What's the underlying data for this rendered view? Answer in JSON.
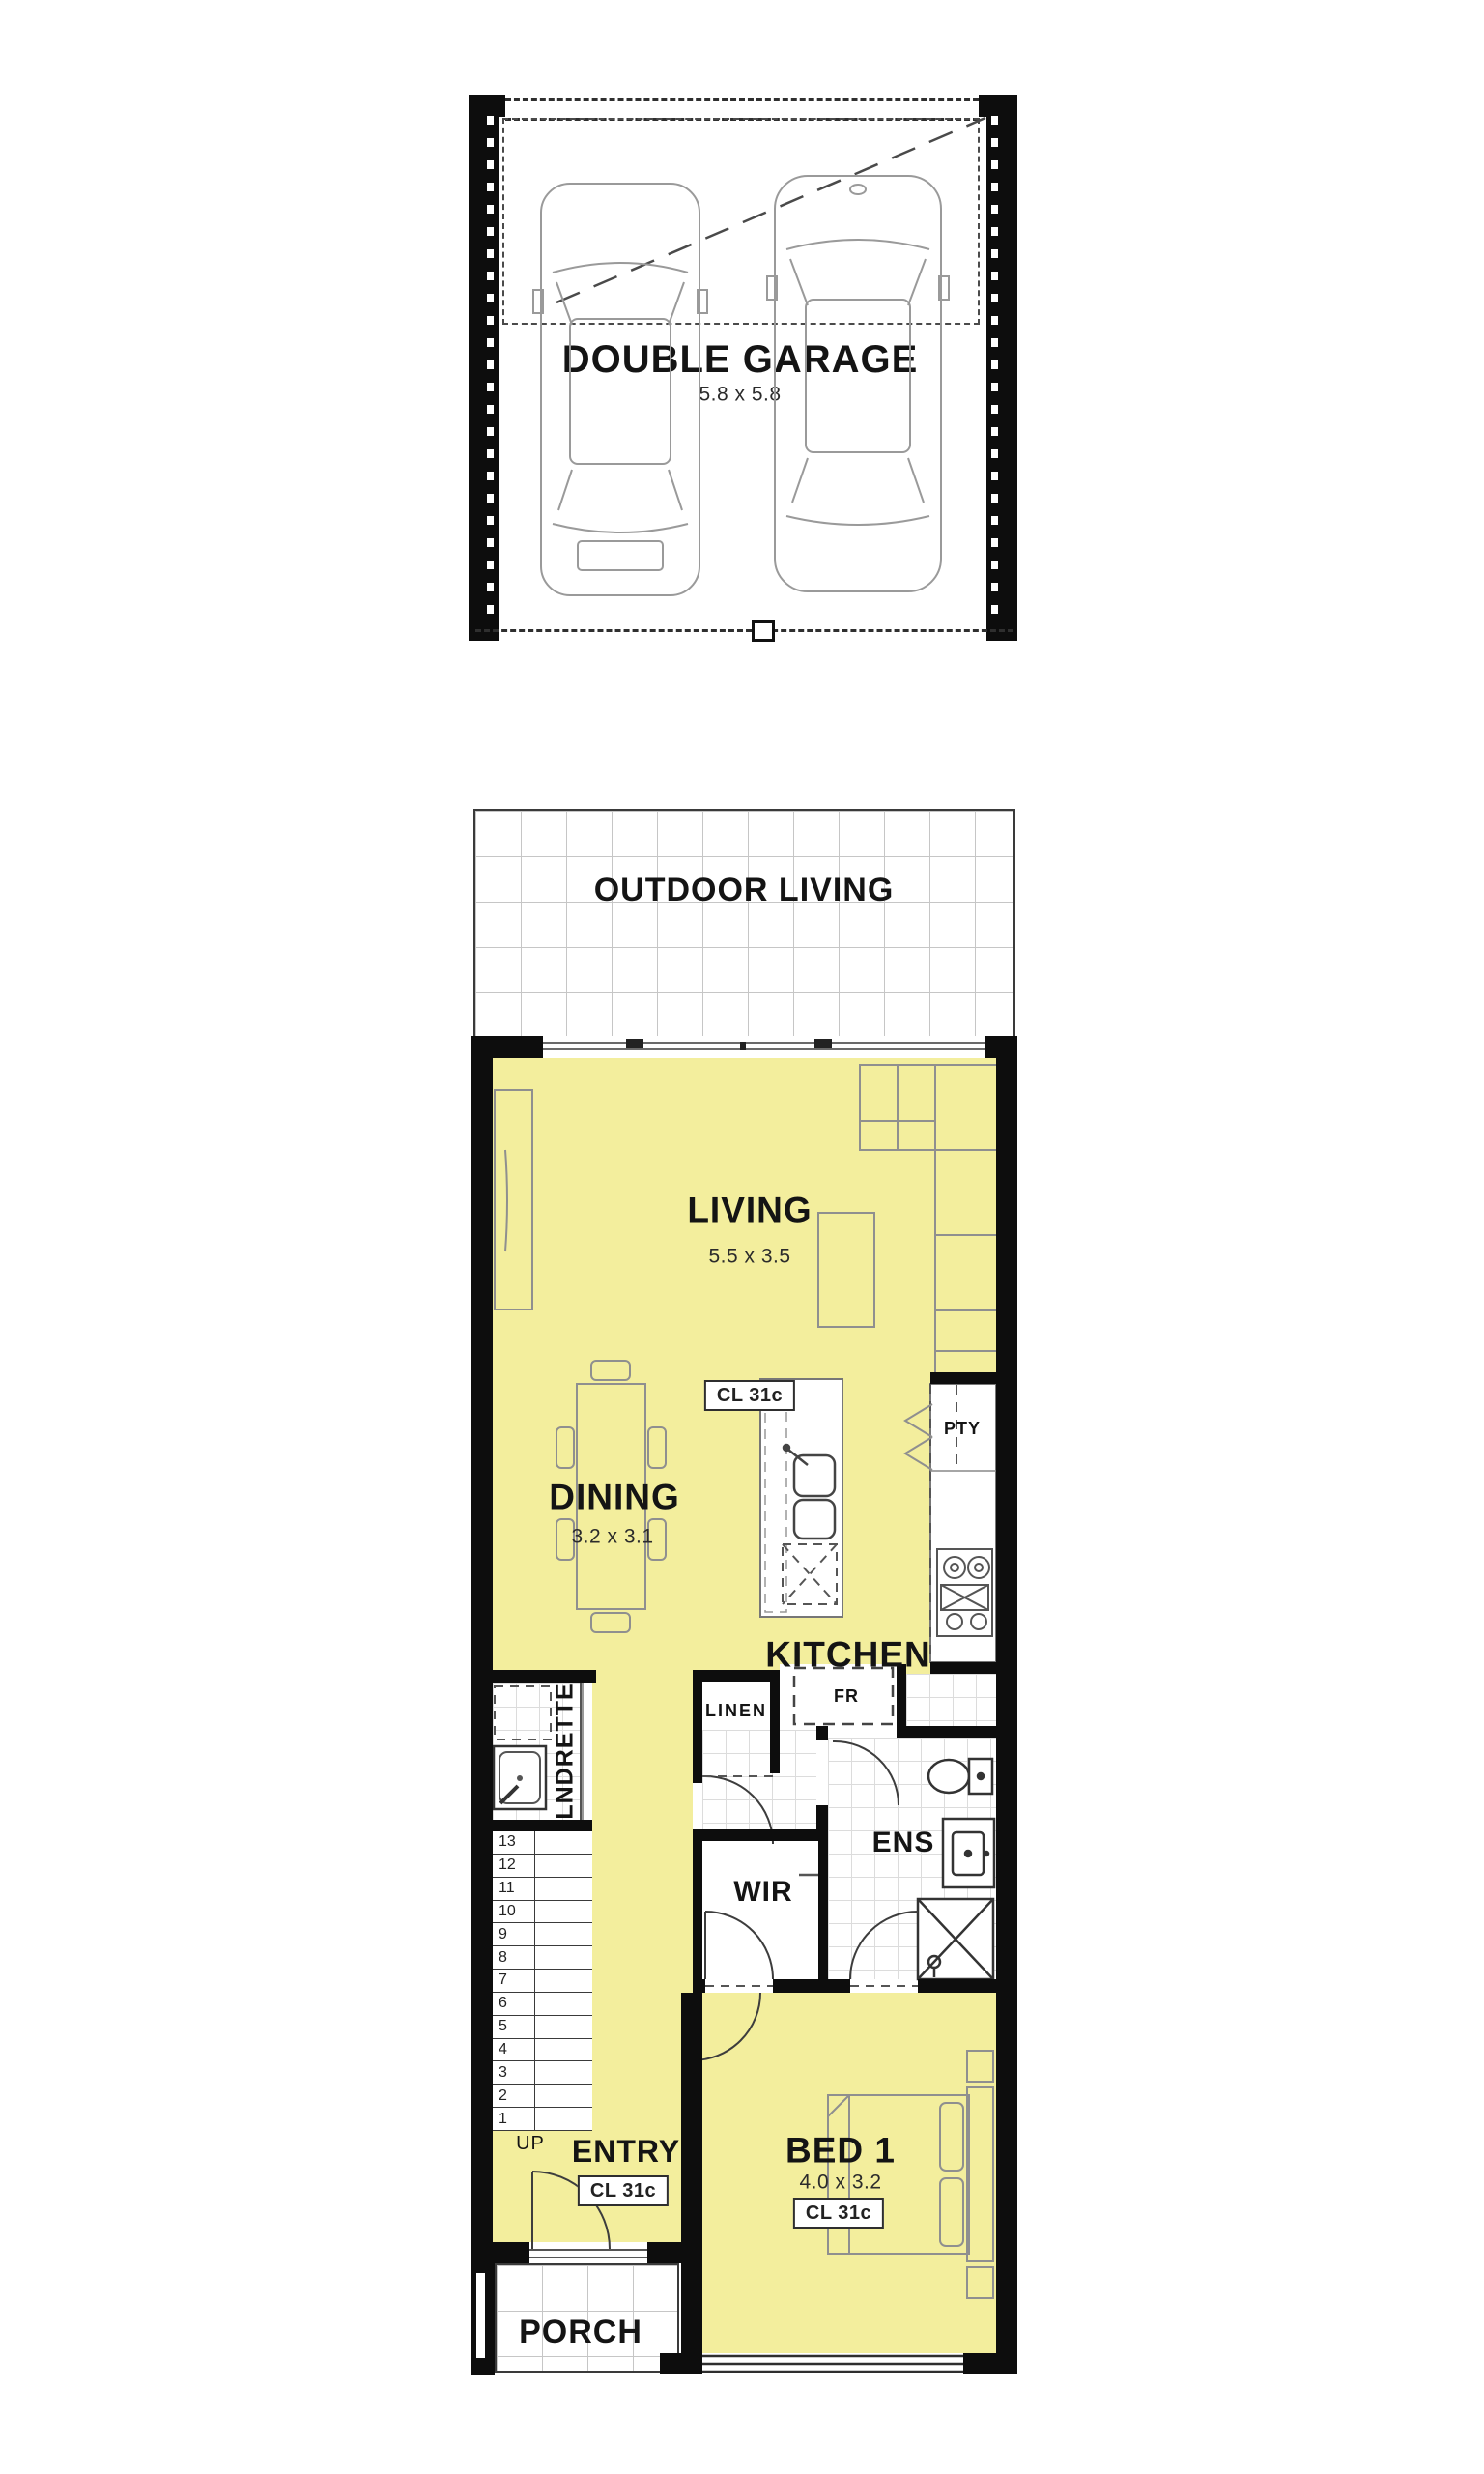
{
  "plan": {
    "garage": {
      "label": "DOUBLE GARAGE",
      "dims": "5.8 x 5.8"
    },
    "outdoor_living": {
      "label": "OUTDOOR LIVING"
    },
    "living": {
      "label": "LIVING",
      "dims": "5.5 x 3.5",
      "ceiling": "CL 31c"
    },
    "dining": {
      "label": "DINING",
      "dims": "3.2 x 3.1"
    },
    "kitchen": {
      "label": "KITCHEN"
    },
    "pantry": {
      "label": "PTY"
    },
    "linen": {
      "label": "LINEN"
    },
    "fridge": {
      "label": "FR"
    },
    "laundrette": {
      "label": "LNDRETTE"
    },
    "ensuite": {
      "label": "ENS"
    },
    "wir": {
      "label": "WIR"
    },
    "stairs": {
      "direction": "UP",
      "treads": [
        "13",
        "12",
        "11",
        "10",
        "9",
        "8",
        "7",
        "6",
        "5",
        "4",
        "3",
        "2",
        "1"
      ]
    },
    "entry": {
      "label": "ENTRY",
      "ceiling": "CL 31c"
    },
    "bed1": {
      "label": "BED 1",
      "dims": "4.0 x 3.2",
      "ceiling": "CL 31c"
    },
    "porch": {
      "label": "PORCH"
    }
  },
  "colors": {
    "room_fill": "#F3EE9D",
    "wall": "#0d0d0d",
    "tile_line": "#c6c6c6"
  }
}
